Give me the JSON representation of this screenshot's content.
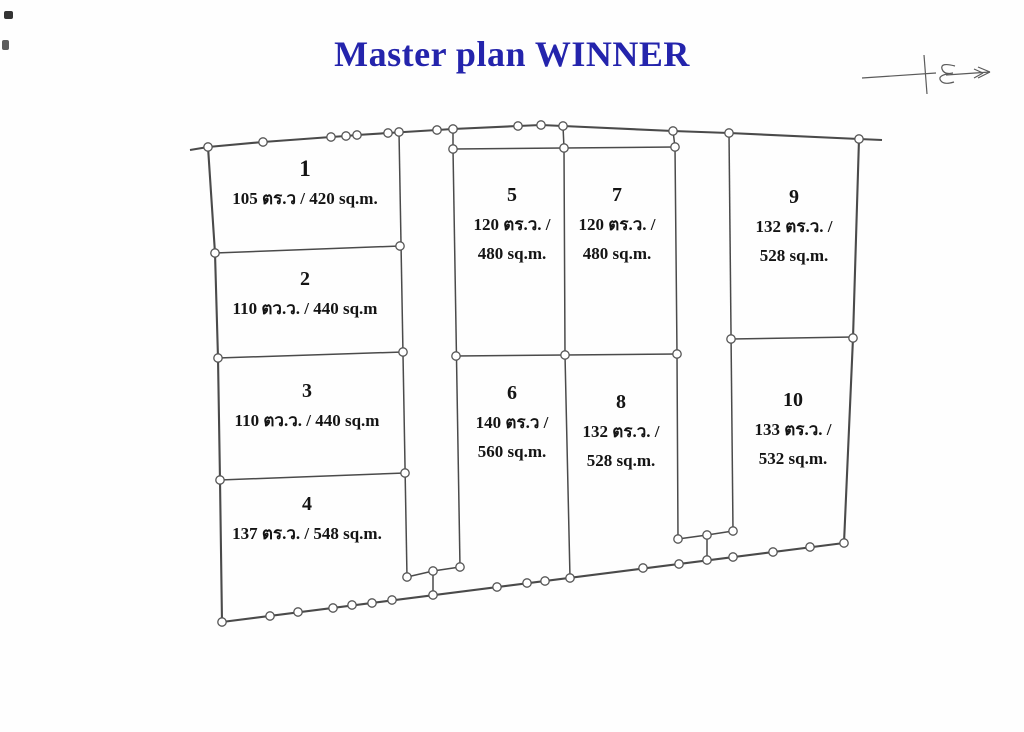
{
  "title": "Master plan WINNER",
  "colors": {
    "title_blue": "#2424ac",
    "line_gray": "#4a4a4a"
  },
  "icons": {
    "north_arrow": "north-arrow-icon"
  },
  "plots": [
    {
      "no": "1",
      "area_lines": [
        "105 ตร.ว / 420 sq.m."
      ]
    },
    {
      "no": "2",
      "area_lines": [
        "110 ตว.ว. / 440 sq.m"
      ]
    },
    {
      "no": "3",
      "area_lines": [
        "110 ตว.ว. / 440 sq.m"
      ]
    },
    {
      "no": "4",
      "area_lines": [
        "137 ตร.ว. / 548 sq.m."
      ]
    },
    {
      "no": "5",
      "area_lines": [
        "120 ตร.ว. /",
        "480 sq.m."
      ]
    },
    {
      "no": "6",
      "area_lines": [
        "140 ตร.ว /",
        "560 sq.m."
      ]
    },
    {
      "no": "7",
      "area_lines": [
        "120 ตร.ว. /",
        "480 sq.m."
      ]
    },
    {
      "no": "8",
      "area_lines": [
        "132 ตร.ว. /",
        "528 sq.m."
      ]
    },
    {
      "no": "9",
      "area_lines": [
        "132 ตร.ว. /",
        "528 sq.m."
      ]
    },
    {
      "no": "10",
      "area_lines": [
        "133 ตร.ว. /",
        "532 sq.m."
      ]
    }
  ]
}
